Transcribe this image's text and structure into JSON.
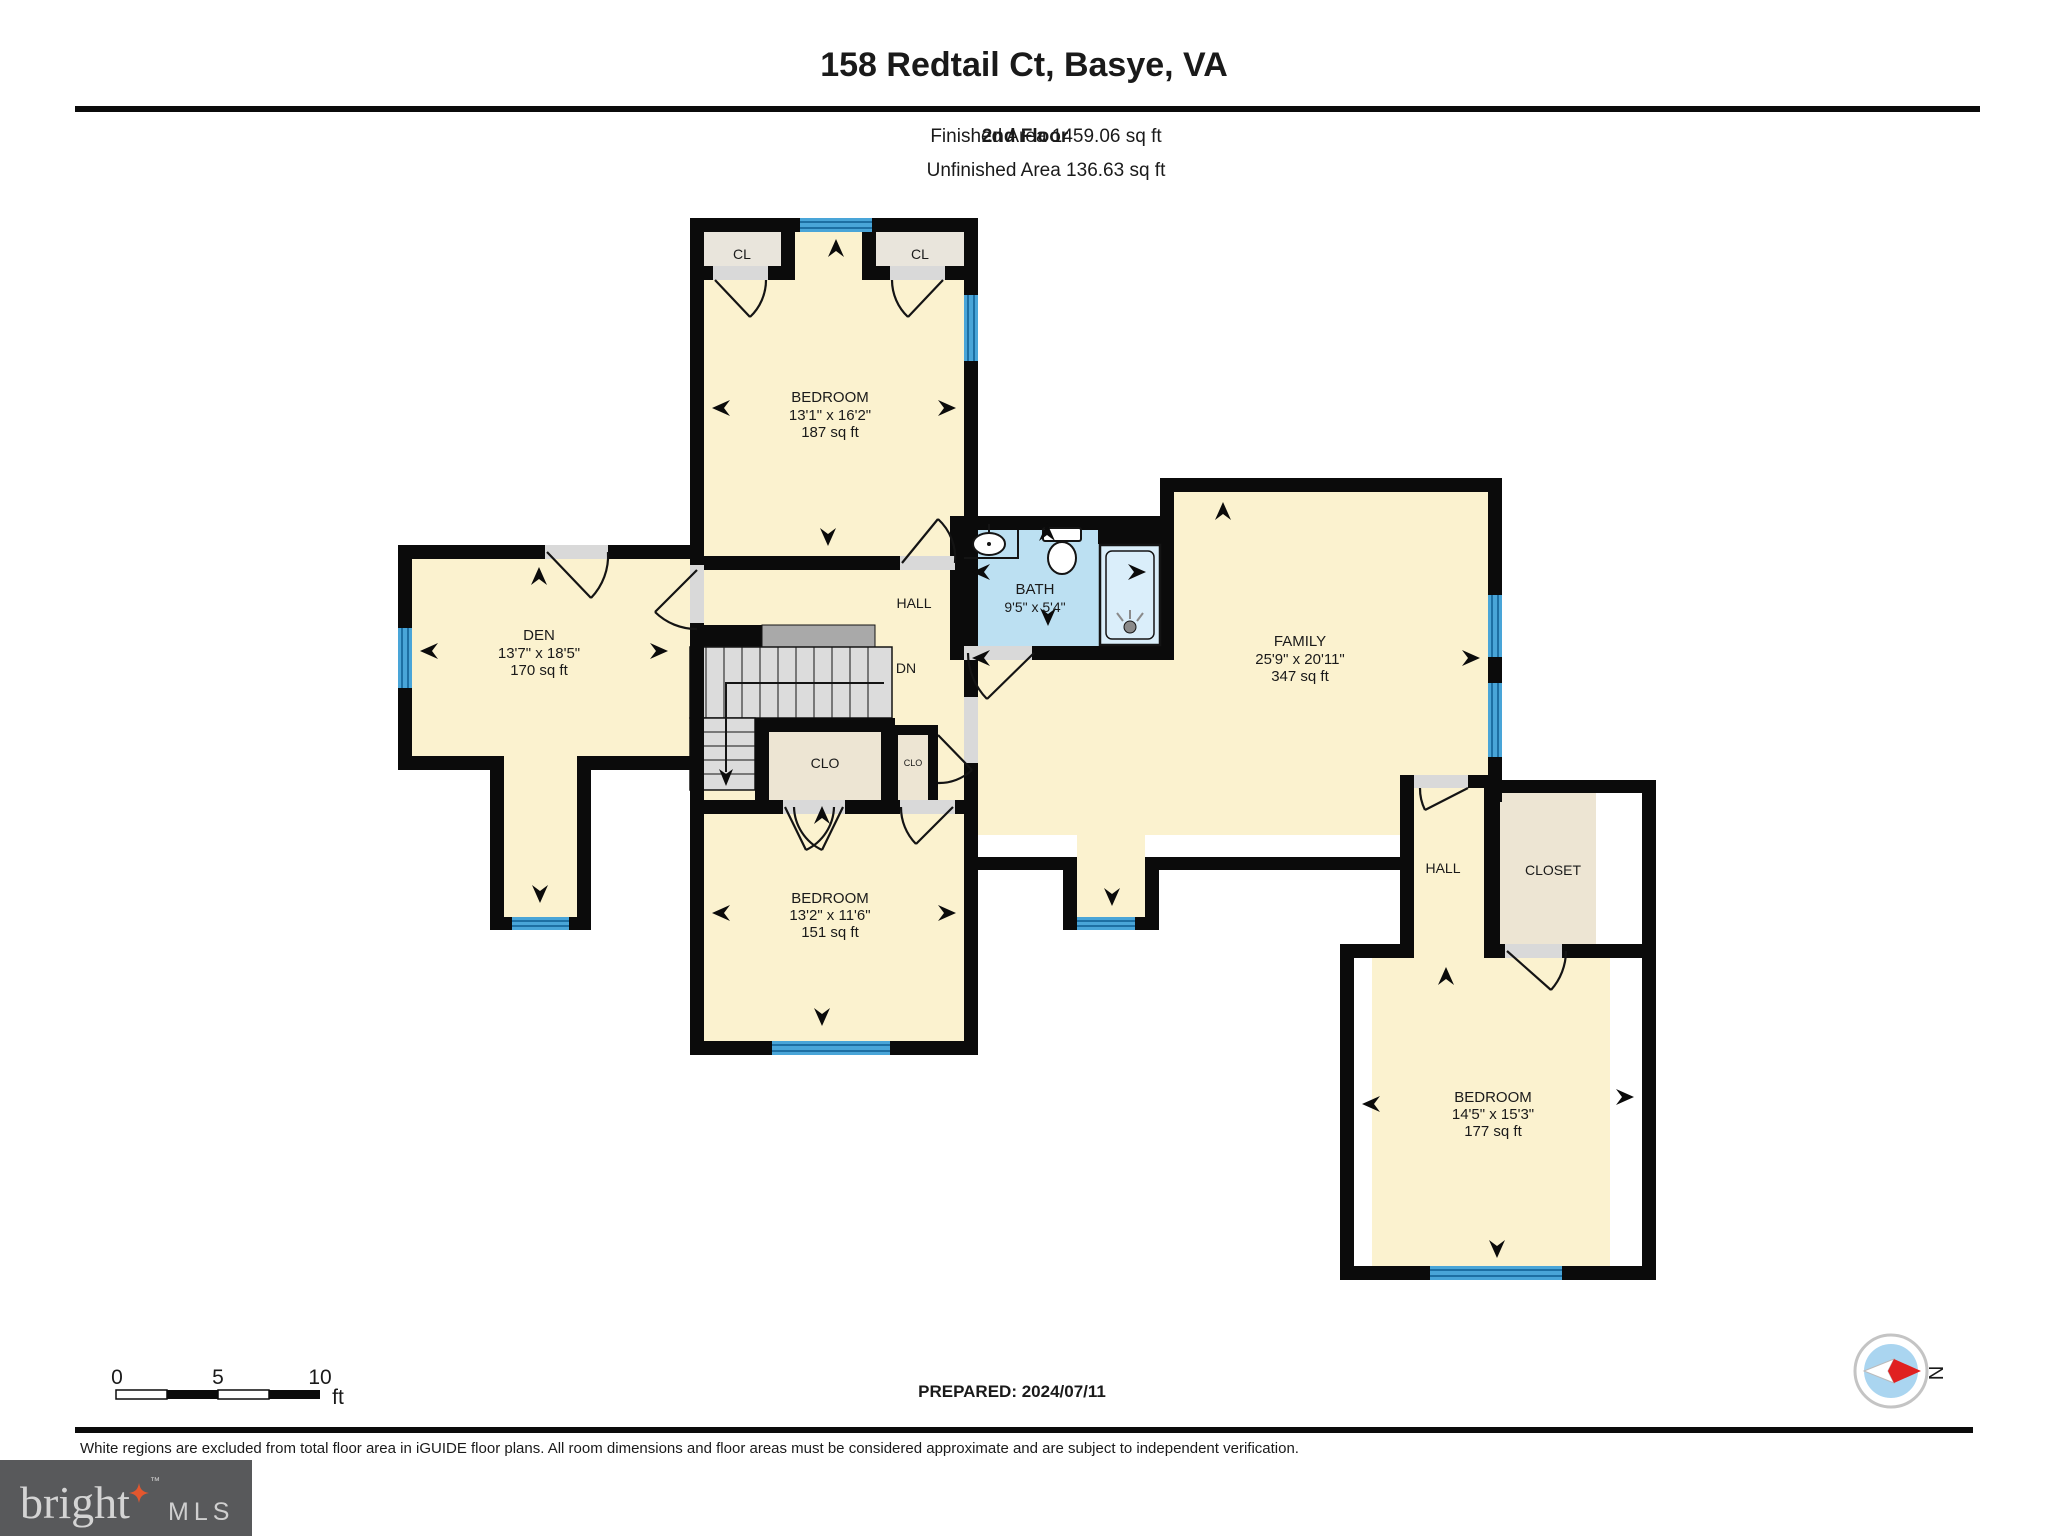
{
  "header": {
    "title": "158 Redtail Ct, Basye, VA",
    "floor_label": "2nd Floor",
    "finished_area": "Finished Area 1459.06 sq ft",
    "unfinished_area": "Unfinished Area 136.63 sq ft"
  },
  "rooms": {
    "bedroom_top": {
      "name": "BEDROOM",
      "dims": "13'1\" x 16'2\"",
      "area": "187 sq ft"
    },
    "closet_left": {
      "name": "CL"
    },
    "closet_right": {
      "name": "CL"
    },
    "den": {
      "name": "DEN",
      "dims": "13'7\" x 18'5\"",
      "area": "170 sq ft"
    },
    "hall_center": {
      "name": "HALL"
    },
    "stairs": {
      "label": "DN"
    },
    "clo_large": {
      "name": "CLO"
    },
    "clo_small": {
      "name": "CLO"
    },
    "bath": {
      "name": "BATH",
      "dims": "9'5\" x 5'4\""
    },
    "family": {
      "name": "FAMILY",
      "dims": "25'9\" x 20'11\"",
      "area": "347 sq ft"
    },
    "bedroom_middle": {
      "name": "BEDROOM",
      "dims": "13'2\" x 11'6\"",
      "area": "151 sq ft"
    },
    "hall_right": {
      "name": "HALL"
    },
    "closet_wing": {
      "name": "CLOSET"
    },
    "bedroom_bottom": {
      "name": "BEDROOM",
      "dims": "14'5\" x 15'3\"",
      "area": "177 sq ft"
    }
  },
  "scale_bar": {
    "tick0": "0",
    "tick5": "5",
    "tick10": "10",
    "unit": "ft"
  },
  "footer": {
    "prepared": "PREPARED: 2024/07/11",
    "disclaimer": "White regions are excluded from total floor area in iGUIDE floor plans. All room dimensions and floor areas must be considered approximate and are subject to independent verification.",
    "compass_label": "N"
  },
  "brand": {
    "name": "bright",
    "tm": "™",
    "suffix": "MLS"
  },
  "colors": {
    "wall": "#0B0B0B",
    "room_fill": "#FBF2CF",
    "closet_fill": "#E9E5DC",
    "bath_fill": "#BCE0F2",
    "window": "#49A5D8",
    "brand_box": "#58595B",
    "brand_star": "#E4572E",
    "compass_needle": "#E02020",
    "compass_inner": "#AAD5F0"
  }
}
